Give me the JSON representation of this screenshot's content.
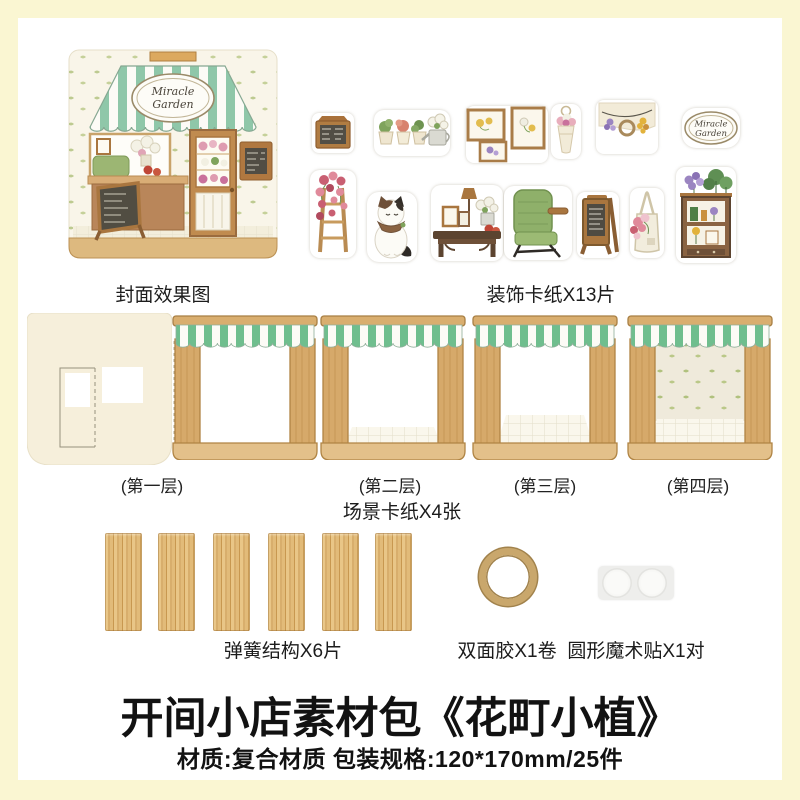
{
  "colors": {
    "background": "#FAF6D2",
    "panel": "#FFFFFF",
    "awning_green": "#6FBE8E",
    "awning_green_cover": "#8FC7A9",
    "wood": "#D6A96A",
    "chalkboard": "#514D44",
    "title_text": "#121212"
  },
  "brand": {
    "line1": "Miracle",
    "line2": "Garden"
  },
  "cover": {
    "caption": "封面效果图"
  },
  "stickers": {
    "caption": "装饰卡纸X13片",
    "count": 13,
    "items": [
      "chalkboard-sign",
      "potted-plants-watering-can",
      "picture-frames",
      "wrapped-bouquet",
      "hanging-flower-garland",
      "miracle-garden-oval-sign",
      "flower-ladder",
      "calico-cat",
      "side-table-with-lamp",
      "green-armchair",
      "a-frame-menu-board",
      "flower-tote-bag",
      "plant-cabinet"
    ]
  },
  "scene_cards": {
    "caption": "场景卡纸X4张",
    "count": 4,
    "labels": [
      "(第一层)",
      "(第二层)",
      "(第三层)",
      "(第四层)"
    ]
  },
  "springs": {
    "caption": "弹簧结构X6片",
    "count": 6
  },
  "tape": {
    "caption": "双面胶X1卷",
    "count": 1
  },
  "velcro": {
    "caption": "圆形魔术贴X1对",
    "count": 1
  },
  "footer": {
    "title": "开间小店素材包《花町小植》",
    "specs": "材质:复合材质 包装规格:120*170mm/25件"
  }
}
